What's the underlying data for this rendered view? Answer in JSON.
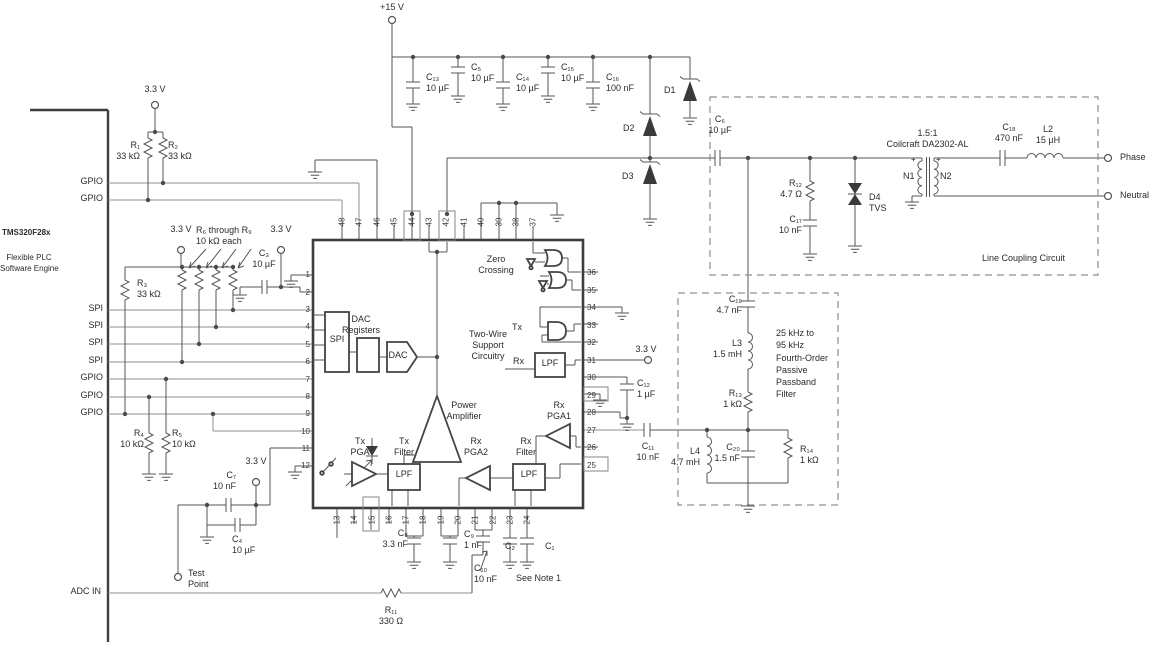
{
  "labels": {
    "v15": "+15 V",
    "v33": "3.3 V",
    "gpio": "GPIO",
    "spi": "SPI",
    "adc_in": "ADC IN",
    "test": [
      "Test",
      "Point"
    ],
    "device": "TMS320F28x",
    "engine": [
      "Flexible PLC",
      "Software Engine"
    ],
    "phase": "Phase",
    "neutral": "Neutral",
    "line_coupling": "Line Coupling Circuit",
    "see_note": "See Note 1",
    "plus": "+"
  },
  "components": {
    "r1": {
      "ref": "R₁",
      "val": "33 kΩ"
    },
    "r2": {
      "ref": "R₂",
      "val": "33 kΩ"
    },
    "r3": {
      "ref": "R₃",
      "val": "33 kΩ"
    },
    "r4": {
      "ref": "R₄",
      "val": "10 kΩ"
    },
    "r5": {
      "ref": "R₅",
      "val": "10 kΩ"
    },
    "r6_9": {
      "ref": "R₆ through R₉",
      "val": "10 kΩ each"
    },
    "r11": {
      "ref": "R₁₁",
      "val": "330 Ω"
    },
    "r12": {
      "ref": "R₁₂",
      "val": "4.7 Ω"
    },
    "r13": {
      "ref": "R₁₃",
      "val": "1 kΩ"
    },
    "r14": {
      "ref": "R₁₄",
      "val": "1 kΩ"
    },
    "c1": {
      "ref": "C₁",
      "val": ""
    },
    "c2": {
      "ref": "C₂",
      "val": ""
    },
    "c3": {
      "ref": "C₃",
      "val": "10 µF"
    },
    "c4": {
      "ref": "C₄",
      "val": "10 µF"
    },
    "c5": {
      "ref": "C₅",
      "val": "10 µF"
    },
    "c6": {
      "ref": "C₆",
      "val": "10 µF"
    },
    "c7": {
      "ref": "C₇",
      "val": "10 nF"
    },
    "c8": {
      "ref": "C₈",
      "val": "3.3 nF"
    },
    "c9": {
      "ref": "C₉",
      "val": "1 nF"
    },
    "c10": {
      "ref": "C₁₀",
      "val": "10 nF"
    },
    "c11": {
      "ref": "C₁₁",
      "val": "10 nF"
    },
    "c12": {
      "ref": "C₁₂",
      "val": "1 µF"
    },
    "c13": {
      "ref": "C₁₃",
      "val": "10 µF"
    },
    "c14": {
      "ref": "C₁₄",
      "val": "10 µF"
    },
    "c15": {
      "ref": "C₁₅",
      "val": "10 µF"
    },
    "c16": {
      "ref": "C₁₆",
      "val": "100 nF"
    },
    "c17": {
      "ref": "C₁₇",
      "val": "10 nF"
    },
    "c18": {
      "ref": "C₁₈",
      "val": "470 nF"
    },
    "c19": {
      "ref": "C₁₉",
      "val": "4.7 nF"
    },
    "c20": {
      "ref": "C₂₀",
      "val": "1.5 nF"
    },
    "l2": {
      "ref": "L2",
      "val": "15 µH"
    },
    "l3": {
      "ref": "L3",
      "val": "1.5 mH"
    },
    "l4": {
      "ref": "L4",
      "val": "4.7 mH"
    },
    "d1": {
      "ref": "D1"
    },
    "d2": {
      "ref": "D2"
    },
    "d3": {
      "ref": "D3"
    },
    "d4": {
      "ref": "D4",
      "val": "TVS"
    }
  },
  "transformer": {
    "ratio": "1.5:1",
    "part": "Coilcraft DA2302-AL",
    "n1": "N1",
    "n2": "N2"
  },
  "filter_note": [
    "25 kHz to",
    "95 kHz",
    "Fourth-Order",
    "Passive",
    "Passband",
    "Filter"
  ],
  "chip": {
    "pins": {
      "top": [
        "48",
        "47",
        "46",
        "45",
        "44",
        "43",
        "42",
        "41",
        "40",
        "39",
        "38",
        "37"
      ],
      "left": [
        "1",
        "2",
        "3",
        "4",
        "5",
        "6",
        "7",
        "8",
        "9",
        "10",
        "11",
        "12"
      ],
      "bottom": [
        "13",
        "14",
        "15",
        "16",
        "17",
        "18",
        "19",
        "20",
        "21",
        "22",
        "23",
        "24"
      ],
      "right": [
        "36",
        "35",
        "34",
        "33",
        "32",
        "31",
        "30",
        "29",
        "28",
        "27",
        "26",
        "25"
      ]
    },
    "blocks": {
      "spi": "SPI",
      "dac_registers": [
        "DAC",
        "Registers"
      ],
      "dac": "DAC",
      "zero_crossing": [
        "Zero",
        "Crossing"
      ],
      "two_wire": [
        "Two-Wire",
        "Support",
        "Circuitry"
      ],
      "tx": "Tx",
      "rx": "Rx",
      "lpf": "LPF",
      "power_amplifier": [
        "Power",
        "Amplifier"
      ],
      "tx_pga": [
        "Tx",
        "PGA"
      ],
      "tx_filter": [
        "Tx",
        "Filter"
      ],
      "rx_pga2": [
        "Rx",
        "PGA2"
      ],
      "rx_filter": [
        "Rx",
        "Filter"
      ],
      "rx_pga1": [
        "Rx",
        "PGA1"
      ]
    }
  }
}
